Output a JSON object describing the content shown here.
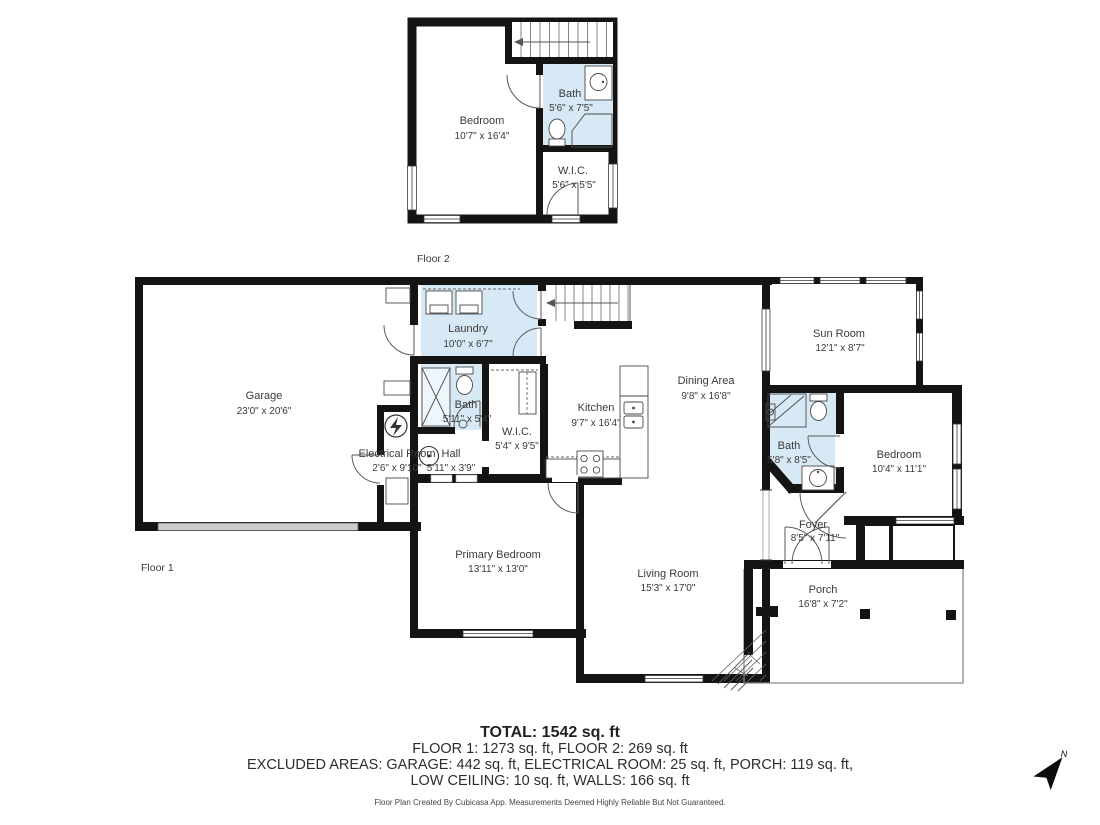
{
  "colors": {
    "wall": "#141414",
    "wet_room_fill": "#d8e9f6",
    "background": "#ffffff",
    "label_text": "#3a3a3a",
    "summary_text": "#2d2d2d"
  },
  "floor2": {
    "label": "Floor 2",
    "rooms": [
      {
        "name": "Bedroom",
        "dims": "10'7\" x 16'4\""
      },
      {
        "name": "Bath",
        "dims": "5'6\" x 7'5\""
      },
      {
        "name": "W.I.C.",
        "dims": "5'6\" x 5'5\""
      }
    ]
  },
  "floor1": {
    "label": "Floor 1",
    "rooms": [
      {
        "name": "Garage",
        "dims": "23'0\" x 20'6\""
      },
      {
        "name": "Laundry",
        "dims": "10'0\" x 6'7\""
      },
      {
        "name": "Electrical Room",
        "dims": "2'6\" x 9'10\""
      },
      {
        "name": "Bath",
        "dims": "5'11\" x 5'4\""
      },
      {
        "name": "Hall",
        "dims": "5'11\" x 3'9\""
      },
      {
        "name": "W.I.C.",
        "dims": "5'4\" x 9'5\""
      },
      {
        "name": "Kitchen",
        "dims": "9'7\" x 16'4\""
      },
      {
        "name": "Dining Area",
        "dims": "9'8\" x 16'8\""
      },
      {
        "name": "Sun Room",
        "dims": "12'1\" x 8'7\""
      },
      {
        "name": "Bath",
        "dims": "5'8\" x 8'5\""
      },
      {
        "name": "Bedroom",
        "dims": "10'4\" x 11'1\""
      },
      {
        "name": "Primary Bedroom",
        "dims": "13'11\" x 13'0\""
      },
      {
        "name": "Living Room",
        "dims": "15'3\" x 17'0\""
      },
      {
        "name": "Foyer",
        "dims": "8'5\" x 7'11\""
      },
      {
        "name": "Porch",
        "dims": "16'8\" x 7'2\""
      }
    ]
  },
  "summary": {
    "total": "TOTAL: 1542 sq. ft",
    "floors_line": "FLOOR 1: 1273 sq. ft, FLOOR 2: 269 sq. ft",
    "excluded_line1": "EXCLUDED AREAS: GARAGE: 442 sq. ft, ELECTRICAL ROOM: 25 sq. ft, PORCH: 119 sq. ft,",
    "excluded_line2": "LOW CEILING: 10 sq. ft, WALLS: 166 sq. ft",
    "disclaimer": "Floor Plan Created By Cubicasa App. Measurements Deemed Highly Reliable But Not Guaranteed."
  },
  "compass": {
    "label": "N"
  }
}
